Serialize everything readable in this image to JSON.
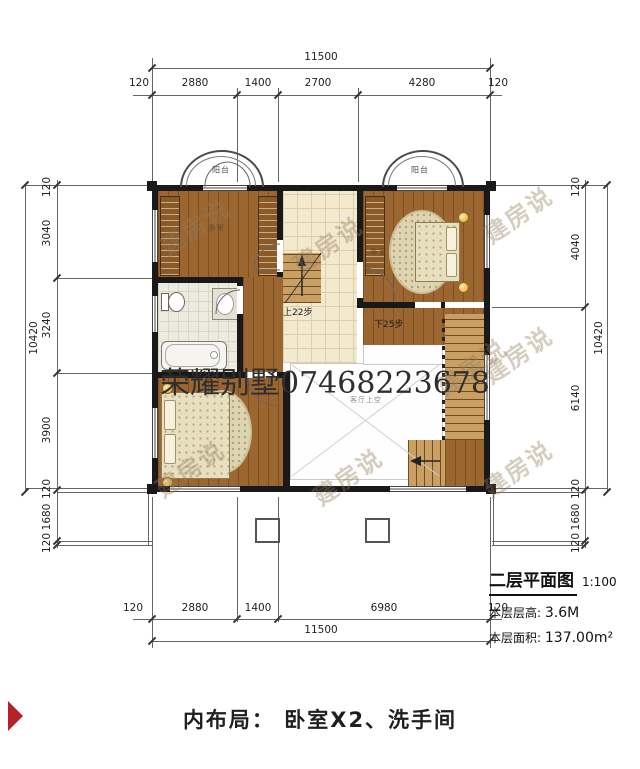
{
  "plan": {
    "title": "二层平面图",
    "scale": "1:100",
    "floor_height_label": "本层层高:",
    "floor_height": "3.6M",
    "floor_area_label": "本层面积:",
    "floor_area": "137.00m²"
  },
  "caption": {
    "text": "内布局： 卧室X2、洗手间"
  },
  "watermarks": {
    "brand": "建房说",
    "phone": "荣耀别墅07468223678"
  },
  "labels": {
    "balcony": "阳台",
    "bedroom": "卧室",
    "living_void": "客厅上空",
    "stairs_up": "上22步",
    "stairs_down": "下25步"
  },
  "dimensions": {
    "top": {
      "overall": "11500",
      "segments": [
        "120",
        "2880",
        "1400",
        "2700",
        "4280",
        "120"
      ]
    },
    "bottom": {
      "overall": "11500",
      "segments": [
        "120",
        "2880",
        "1400",
        "6980",
        "120"
      ]
    },
    "left": {
      "overall": "10420",
      "segments": [
        "120",
        "3040",
        "3240",
        "3900",
        "120",
        "1680",
        "120"
      ]
    },
    "right": {
      "overall": "10420",
      "segments": [
        "120",
        "4040",
        "6140",
        "120",
        "1680",
        "120"
      ]
    }
  },
  "colors": {
    "wall": "#191919",
    "wood_floor": "#9c6630",
    "tile_floor": "#f3e9cf",
    "bath_tile": "#edebe0",
    "stair": "#c99f63",
    "accent_red": "#b5222a",
    "dim_text": "#222222"
  }
}
